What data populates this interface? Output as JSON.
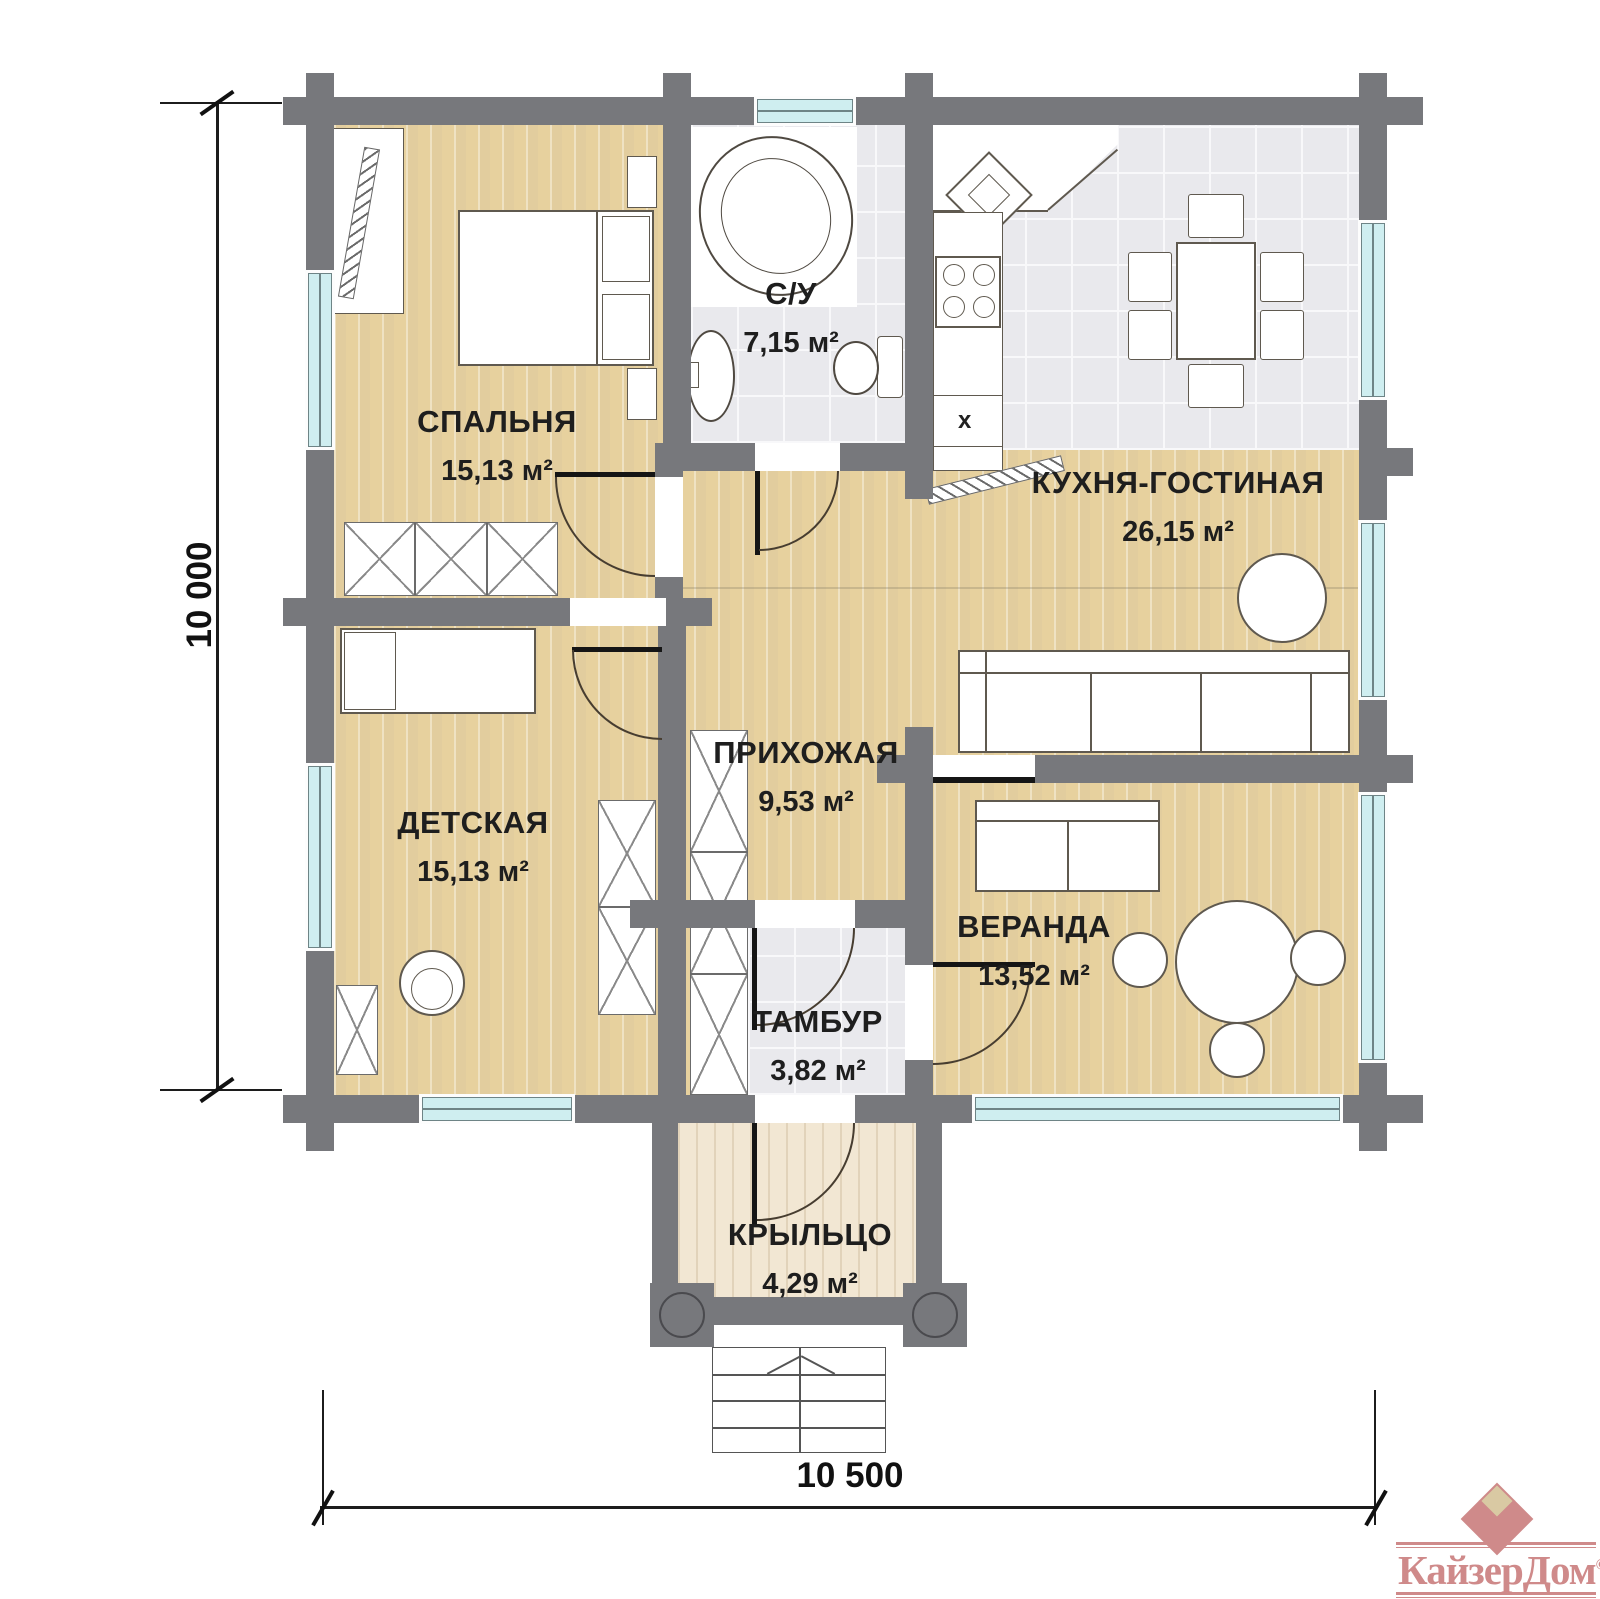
{
  "plan": {
    "rooms": [
      {
        "name": "СПАЛЬНЯ",
        "area": "15,13 м²"
      },
      {
        "name": "С/У",
        "area": "7,15 м²"
      },
      {
        "name": "КУХНЯ-ГОСТИНАЯ",
        "area": "26,15 м²"
      },
      {
        "name": "ПРИХОЖАЯ",
        "area": "9,53 м²"
      },
      {
        "name": "ДЕТСКАЯ",
        "area": "15,13 м²"
      },
      {
        "name": "ВЕРАНДА",
        "area": "13,52 м²"
      },
      {
        "name": "ТАМБУР",
        "area": "3,82 м²"
      },
      {
        "name": "КРЫЛЬЦО",
        "area": "4,29 м²"
      }
    ],
    "dimensions": {
      "height_mm": "10 000",
      "width_mm": "10 500"
    },
    "kitchen_cabinet_mark": "x",
    "colors": {
      "wall": "#77787c",
      "window": "#cfeef0",
      "wood": "#ebd8ab",
      "tile": "#e9e9ed",
      "porch_wood": "#f2e7d3",
      "logo": "#cf8a8a"
    }
  },
  "logo": {
    "brand": "КайзерДом",
    "copyright": "©"
  }
}
